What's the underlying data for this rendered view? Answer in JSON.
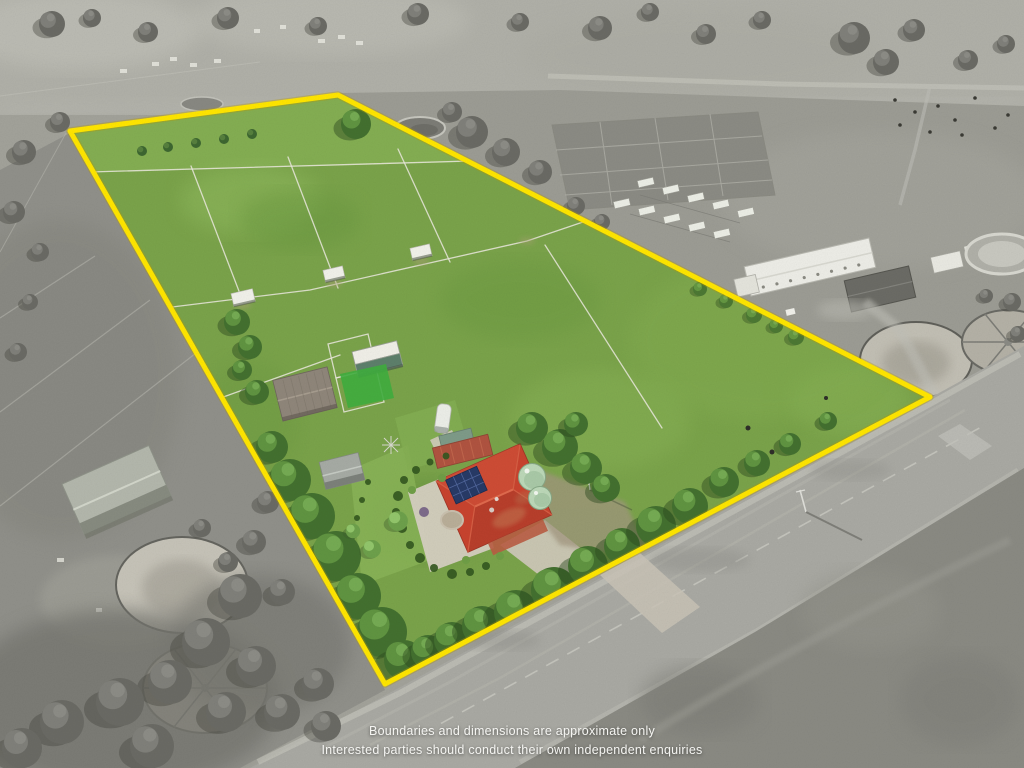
{
  "disclaimer": {
    "line1": "Boundaries and dimensions are approximate only",
    "line2": "Interested parties should conduct their own independent enquiries"
  },
  "colors": {
    "boundary_yellow": "#FFE600",
    "grass_green": "#7AA34A",
    "roof_red": "#C8432E",
    "solar_panel_blue": "#273A66",
    "water_tank_mint": "#BCD8B8",
    "road_gray": "#A9A9A3",
    "text_white": "#F5F5F2"
  },
  "scene": {
    "description": "Oblique aerial drone photograph of a rural acreage for sale: land inside the yellow boundary outline is shown in colour, all surrounding land is desaturated grey",
    "features": [
      "fenced green paddocks",
      "three field shelters",
      "stable shed and barn",
      "homestead with red hip roof and solar panels",
      "two rain water tanks",
      "gardens and mature trees",
      "sealed road frontage",
      "neighbouring horse facility with round yards"
    ]
  }
}
